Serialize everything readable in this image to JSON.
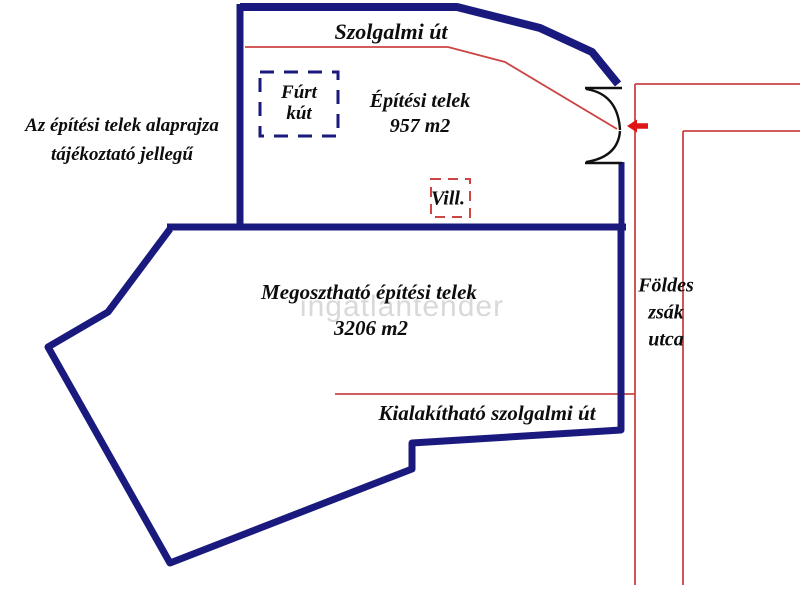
{
  "note": {
    "line1": "Az építési telek alaprajza",
    "line2": "tájékoztató jellegű"
  },
  "top_road_label": "Szolgalmi út",
  "well": {
    "line1": "Fúrt",
    "line2": "kút"
  },
  "upper_plot": {
    "name": "Építési telek",
    "area": "957 m2"
  },
  "utility_label": "Vill.",
  "lower_plot": {
    "name": "Megosztható építési telek",
    "area": "3206 m2"
  },
  "bottom_road_label": "Kialakítható szolgalmi út",
  "street": {
    "line1": "Földes",
    "line2": "zsák",
    "line3": "utca"
  },
  "watermark": "ingatlantender",
  "colors": {
    "plot_border_navy": "#1a1a7e",
    "street_line_red": "#cc4444",
    "arrow_red": "#e01414",
    "text_black": "#0d0d0d",
    "watermark_gray": "#d9d9d9"
  },
  "icons": {
    "gate_symbol": "double-swing-gate",
    "arrow": "entrance-arrow-left"
  }
}
